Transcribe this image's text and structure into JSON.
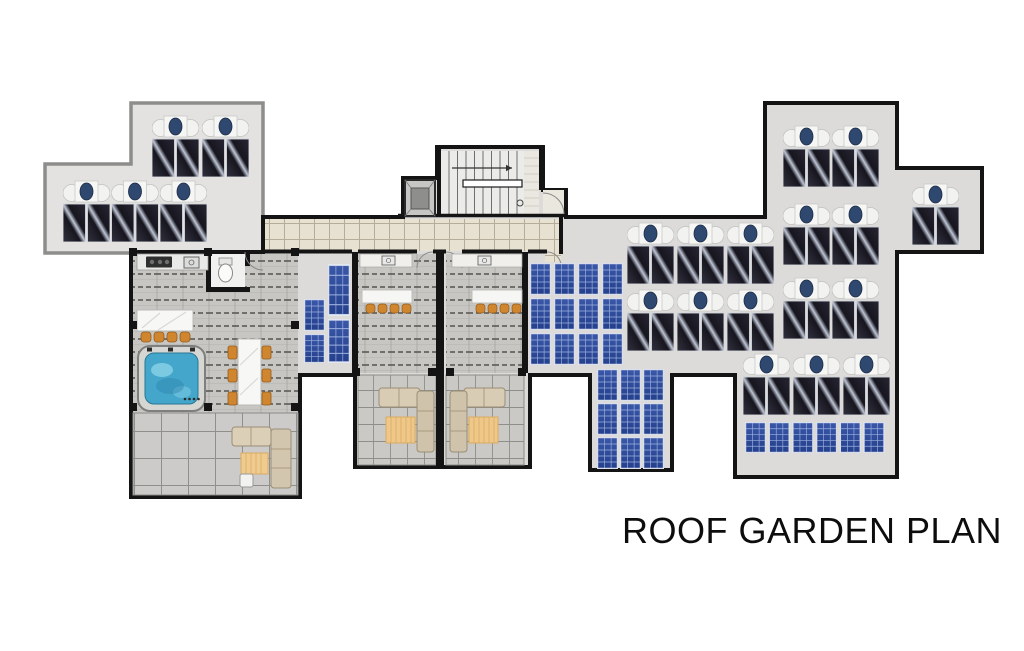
{
  "title": {
    "text": "ROOF GARDEN PLAN"
  },
  "plan": {
    "name": "roof-garden-plan",
    "colors": {
      "roof_gray": "#dcdbd9",
      "upper_block_gray": "#e3e2e0",
      "outline_black": "#141414",
      "outline_gray": "#8d8d8b",
      "corridor_tile": "#e7e1d2",
      "pergola_floor": "#c7c6c3",
      "terrace_tile": "#cbcac8",
      "pv_blue": "#2b4492",
      "thermal_panel_dark": "#17161f",
      "boiler_white": "#f6f6f4",
      "boiler_circle_blue": "#2f4870",
      "stool_orange": "#d0852f",
      "sofa_beige": "#d8ccb4",
      "rug_tan": "#eec789",
      "hot_tub_water": "#43a6ca",
      "marble_white": "#f7f7f5"
    },
    "solar_thermal_rows": [
      {
        "x": 152,
        "y": 115,
        "count": 2,
        "step": 50
      },
      {
        "x": 63,
        "y": 180,
        "count": 3,
        "step": 48.5
      },
      {
        "x": 627,
        "y": 222,
        "count": 3,
        "step": 50
      },
      {
        "x": 627,
        "y": 289,
        "count": 3,
        "step": 50
      },
      {
        "x": 783,
        "y": 125,
        "count": 2,
        "step": 49
      },
      {
        "x": 783,
        "y": 203,
        "count": 2,
        "step": 49
      },
      {
        "x": 783,
        "y": 277,
        "count": 2,
        "step": 49
      },
      {
        "x": 912,
        "y": 183,
        "count": 1,
        "step": 49
      },
      {
        "x": 743,
        "y": 353,
        "count": 3,
        "step": 50
      }
    ],
    "unit_size": {
      "w": 47,
      "h": 62
    },
    "pv_arrays": [
      {
        "name": "pv-array-left-small",
        "panels": [
          [
            304,
            299,
            21,
            32
          ],
          [
            304,
            334,
            21,
            29
          ],
          [
            328,
            264,
            22,
            52
          ],
          [
            328,
            319,
            22,
            44
          ]
        ]
      },
      {
        "name": "pv-array-central-large",
        "x": 530,
        "y": 263,
        "cols": 4,
        "rows": 3,
        "pw": 21,
        "ph": 32,
        "sx": 24,
        "sy": 35
      },
      {
        "name": "pv-array-lower-center",
        "x": 597,
        "y": 369,
        "cols": 3,
        "rows": 3,
        "pw": 21,
        "ph": 32,
        "sx": 23,
        "sy": 34
      },
      {
        "name": "pv-array-bottom-right-row",
        "x": 745,
        "y": 422,
        "cols": 6,
        "rows": 1,
        "pw": 21,
        "ph": 31,
        "sx": 23.7,
        "sy": 0
      }
    ],
    "columns": [
      [
        129,
        248
      ],
      [
        204,
        248
      ],
      [
        291,
        248
      ],
      [
        129,
        321
      ],
      [
        291,
        321
      ],
      [
        129,
        403
      ],
      [
        204,
        403
      ],
      [
        291,
        403
      ],
      [
        352,
        368
      ],
      [
        428,
        368
      ],
      [
        446,
        368
      ],
      [
        518,
        368
      ]
    ]
  }
}
